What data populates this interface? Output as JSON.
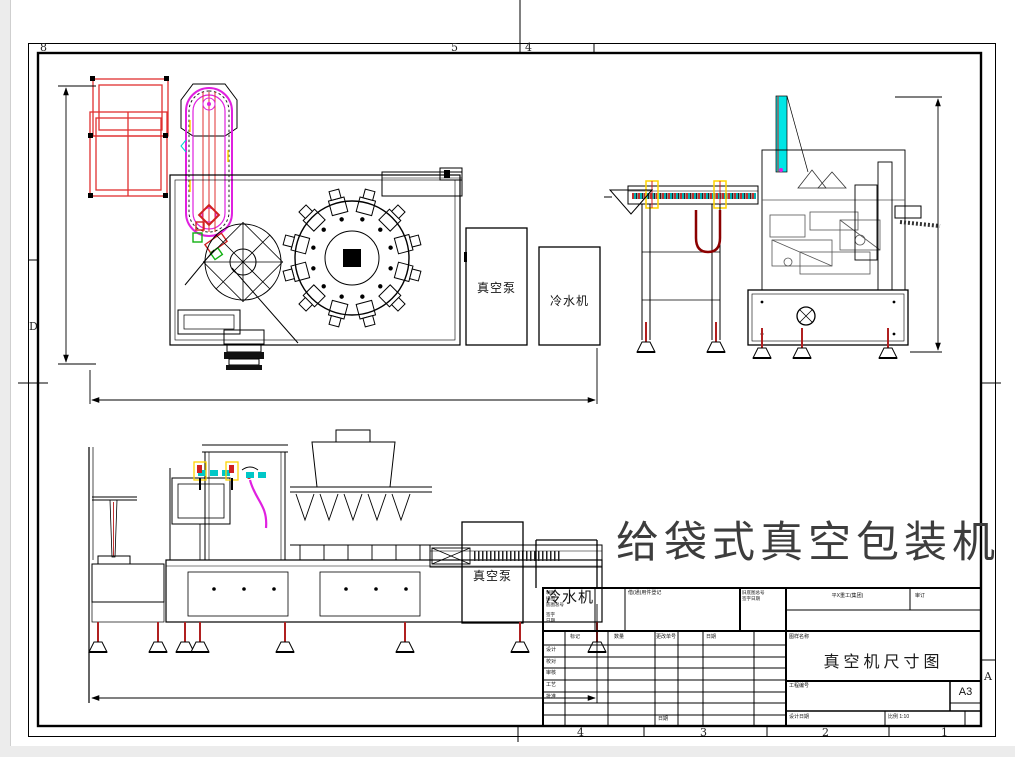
{
  "drawing": {
    "main_title": "给袋式真空包装机",
    "vacuum_pump_label": "真空泵",
    "chiller_label": "冷水机"
  },
  "border_zones": {
    "top": [
      "8",
      "5",
      "4"
    ],
    "bottom": [
      "4",
      "3",
      "2",
      "1"
    ],
    "left": "D",
    "right": "A"
  },
  "title_block": {
    "drawing_name": "真空机尺寸图",
    "paper_size": "A3",
    "scale": "比例 1:10",
    "company": "平X重工(集团)",
    "approve": "审订",
    "register_label": "借(通)用件登记",
    "old_no_label": "旧底图总号",
    "sign_date_label": "签字日期",
    "name_label": "图样名称",
    "project_label": "工程编号",
    "date_label": "设计日期",
    "sheet_note": "日期",
    "stub_lines": [
      "制图",
      "描图",
      "底图总号",
      "签字",
      "日期"
    ],
    "grid_header": [
      "标记",
      "数量",
      "更改单号",
      "日期"
    ],
    "row_labels": [
      "设计",
      "校对",
      "审核",
      "工艺",
      "批准"
    ]
  },
  "colors": {
    "line": "#000000",
    "magenta": "#e020e0",
    "red": "#d02020",
    "cyan": "#00d5d5",
    "yellow": "#ffd400",
    "green": "#12b012",
    "dark_red": "#8b0000",
    "title_gray": "#3d3d3d"
  }
}
